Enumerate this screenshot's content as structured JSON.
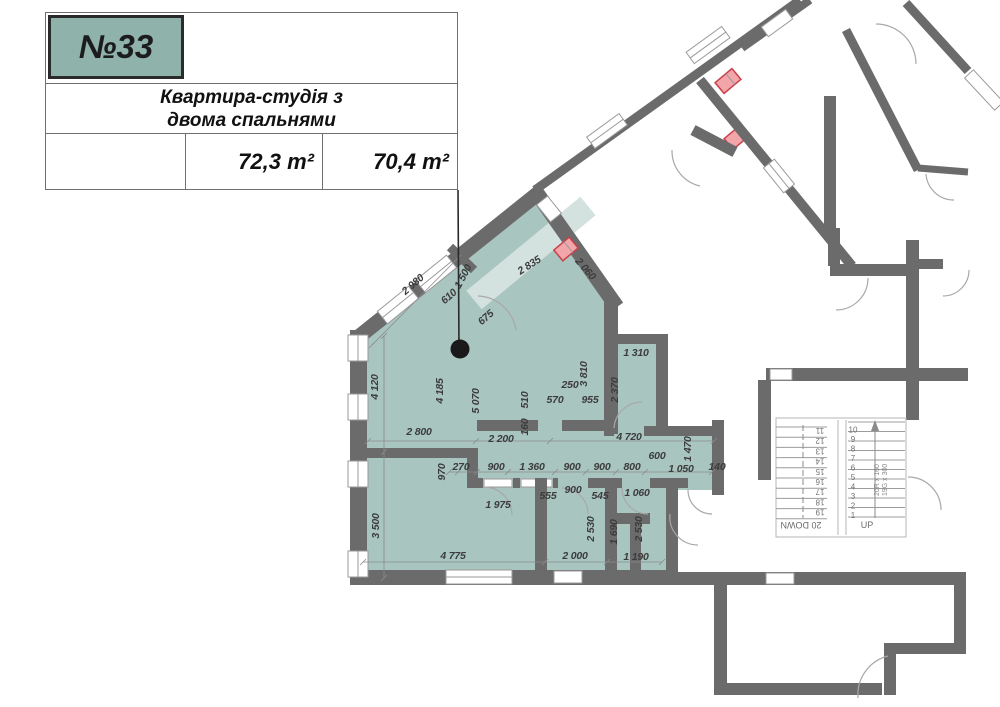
{
  "title_block": {
    "apartment_number": "№33",
    "name_line1": "Квартира-студія з",
    "name_line2": "двома спальнями",
    "total_area": "72,3 m²",
    "reduced_area": "70,4 m²"
  },
  "colors": {
    "apartment_fill": "#a9c5bf",
    "number_box_fill": "#8fb2ab",
    "wall_gray": "#6b6b6b",
    "vent_red": "#c9404a",
    "vent_fill": "#f2a6aa",
    "dim_text": "#3c3c3c"
  },
  "dimensions": [
    {
      "t": "2 980",
      "x": 415,
      "y": 287,
      "r": -41
    },
    {
      "t": "610",
      "x": 451,
      "y": 299,
      "r": -41
    },
    {
      "t": "1 500",
      "x": 466,
      "y": 278,
      "r": -62
    },
    {
      "t": "675",
      "x": 488,
      "y": 320,
      "r": -41
    },
    {
      "t": "2 835",
      "x": 531,
      "y": 268,
      "r": -33
    },
    {
      "t": "2 060",
      "x": 583,
      "y": 271,
      "r": 49
    },
    {
      "t": "4 120",
      "x": 378,
      "y": 387,
      "r": -90
    },
    {
      "t": "4 185",
      "x": 443,
      "y": 391,
      "r": -90
    },
    {
      "t": "5 070",
      "x": 479,
      "y": 401,
      "r": -90
    },
    {
      "t": "510",
      "x": 528,
      "y": 400,
      "r": -90
    },
    {
      "t": "160",
      "x": 528,
      "y": 427,
      "r": -90
    },
    {
      "t": "570",
      "x": 555,
      "y": 403,
      "r": 0
    },
    {
      "t": "250",
      "x": 570,
      "y": 388,
      "r": 0
    },
    {
      "t": "955",
      "x": 590,
      "y": 403,
      "r": 0
    },
    {
      "t": "3 810",
      "x": 587,
      "y": 374,
      "r": -90
    },
    {
      "t": "2 370",
      "x": 618,
      "y": 390,
      "r": -90
    },
    {
      "t": "1 310",
      "x": 636,
      "y": 356,
      "r": 0
    },
    {
      "t": "2 800",
      "x": 419,
      "y": 435,
      "r": 0
    },
    {
      "t": "2 200",
      "x": 501,
      "y": 442,
      "r": 0
    },
    {
      "t": "4 720",
      "x": 629,
      "y": 440,
      "r": 0
    },
    {
      "t": "600",
      "x": 657,
      "y": 459,
      "r": 0
    },
    {
      "t": "1 470",
      "x": 691,
      "y": 449,
      "r": -90
    },
    {
      "t": "1 050",
      "x": 681,
      "y": 472,
      "r": 0
    },
    {
      "t": "140",
      "x": 717,
      "y": 470,
      "r": 0
    },
    {
      "t": "970",
      "x": 445,
      "y": 472,
      "r": -90
    },
    {
      "t": "270",
      "x": 461,
      "y": 470,
      "r": 0
    },
    {
      "t": "900",
      "x": 496,
      "y": 470,
      "r": 0
    },
    {
      "t": "1 360",
      "x": 532,
      "y": 470,
      "r": 0
    },
    {
      "t": "900",
      "x": 572,
      "y": 470,
      "r": 0
    },
    {
      "t": "900",
      "x": 602,
      "y": 470,
      "r": 0
    },
    {
      "t": "800",
      "x": 632,
      "y": 470,
      "r": 0
    },
    {
      "t": "555",
      "x": 548,
      "y": 499,
      "r": 0
    },
    {
      "t": "900",
      "x": 573,
      "y": 493,
      "r": 0
    },
    {
      "t": "545",
      "x": 600,
      "y": 499,
      "r": 0
    },
    {
      "t": "1 060",
      "x": 637,
      "y": 496,
      "r": 0
    },
    {
      "t": "1 975",
      "x": 498,
      "y": 508,
      "r": 0
    },
    {
      "t": "3 500",
      "x": 379,
      "y": 526,
      "r": -90
    },
    {
      "t": "2 530",
      "x": 594,
      "y": 529,
      "r": -90
    },
    {
      "t": "1 690",
      "x": 617,
      "y": 532,
      "r": -90
    },
    {
      "t": "2 530",
      "x": 642,
      "y": 529,
      "r": -90
    },
    {
      "t": "4 775",
      "x": 453,
      "y": 559,
      "r": 0
    },
    {
      "t": "2 000",
      "x": 575,
      "y": 559,
      "r": 0
    },
    {
      "t": "1 190",
      "x": 636,
      "y": 560,
      "r": 0
    }
  ],
  "stairs": {
    "up_label": "UP",
    "down_label": "20 DOWN",
    "riser_note": "20R x 160",
    "going_note": "19G x 300",
    "up_numbers": [
      "1",
      "2",
      "3",
      "4",
      "5",
      "6",
      "7",
      "8",
      "9",
      "10"
    ],
    "down_numbers": [
      "11",
      "12",
      "13",
      "14",
      "15",
      "16",
      "17",
      "18",
      "19"
    ]
  }
}
